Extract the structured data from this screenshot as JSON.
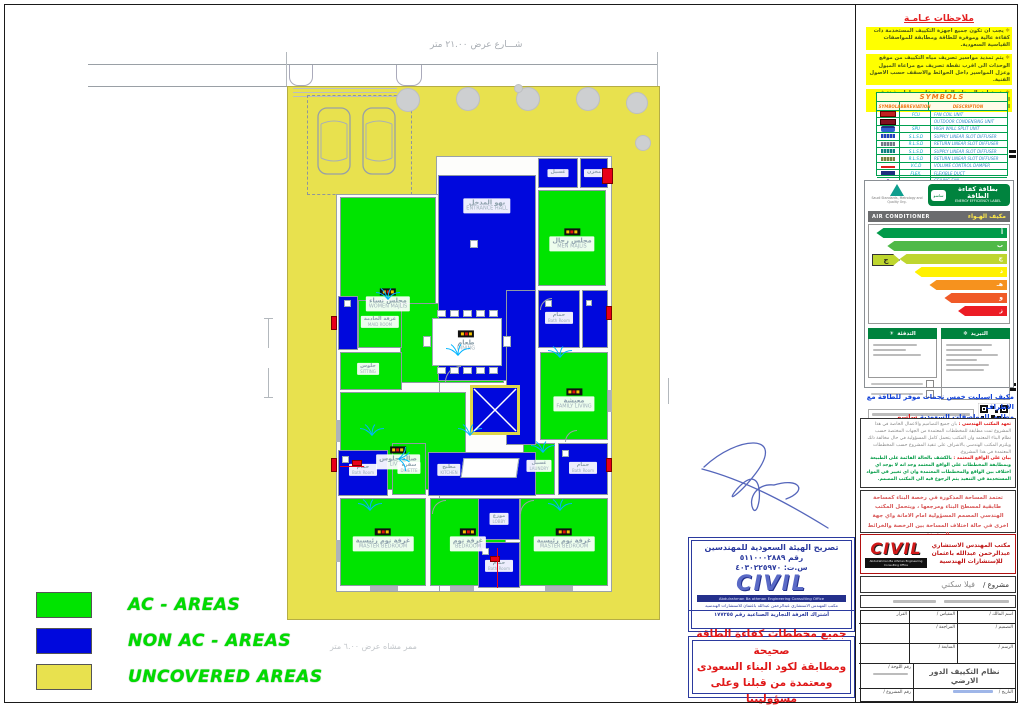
{
  "site": {
    "street_label": "شـــارع عرض ٢١.٠٠ متر",
    "walkway_label": "ممر مشاه عرض ٦.٠٠ متر"
  },
  "legend": {
    "items": [
      {
        "label": "AC - AREAS",
        "color": "#00e400"
      },
      {
        "label": "NON AC - AREAS",
        "color": "#0008dd"
      },
      {
        "label": "UNCOVERED AREAS",
        "color": "#e8e14e"
      }
    ]
  },
  "plan": {
    "rooms": {
      "women-majlis": {
        "ar": "مجلس نساء",
        "en": "WOMEN MAJLIS"
      },
      "men-majlis": {
        "ar": "مجلس رجال",
        "en": "MEN MAJLIS"
      },
      "dining": {
        "ar": "طعام",
        "en": "DINING"
      },
      "maid-room": {
        "ar": "غرفة الخادمة",
        "en": "MAID ROOM"
      },
      "sitting": {
        "ar": "جلوس",
        "en": "SITTING"
      },
      "living-hall": {
        "ar": "صالة جلوس",
        "en": "LIVING"
      },
      "family-living": {
        "ar": "معيشة",
        "en": "FAMILY LIVING"
      },
      "master-bedroom-left": {
        "ar": "غرفة نوم رئيسية",
        "en": "MASTER BEDROOM"
      },
      "bedroom-middle": {
        "ar": "غرفة نوم",
        "en": "BEDROOM"
      },
      "master-bedroom-right": {
        "ar": "غرفة نوم رئيسية",
        "en": "MASTER BEDROOM"
      },
      "laundry": {
        "ar": "غسيل",
        "en": "LAUNDRY"
      },
      "dinette": {
        "ar": "سفرة",
        "en": "DINETTE"
      },
      "entrance-hall": {
        "ar": "بهو المدخل",
        "en": "ENTRANCE HALL"
      },
      "store-a": {
        "ar": "غسيل",
        "en": ""
      },
      "store-b": {
        "ar": "مخزن",
        "en": ""
      },
      "bath-tr": {
        "ar": "حمام",
        "en": "Bath Room"
      },
      "bath-bl": {
        "ar": "حمام",
        "en": "Bath Room"
      },
      "kitchen": {
        "ar": "مطبخ",
        "en": "KITCHEN"
      },
      "lobby": {
        "ar": "موزع",
        "en": "LOBBY"
      },
      "bath-bm": {
        "ar": "حمام",
        "en": "Bath Room"
      },
      "bath-br": {
        "ar": "حمام",
        "en": "Bath Room"
      }
    }
  },
  "notes": {
    "title": "ملاحظات عـامـة",
    "items": [
      "يجب ان تكون جميع اجهزة التكييف المستخدمة ذات كفاءة عالية وموفرة للطاقة ومطابقة للمواصفات القياسية السعودية.",
      "يتم تمديد مواسير تصريف مياه التكييف من موقع الوحدات الى اقرب نقطة تصريف مع مراعاة الميول وعزل المواسير داخل الحوائط والاسقف حسب الاصول الفنية.",
      "يتم تعليق الوحدات الخارجية على حوامل مثبتة في الحوائط او على ارضية السطح مع مراعاة سهولة الصيانة والتهوية الجيدة."
    ]
  },
  "symbols": {
    "title": "SYMBOLS",
    "headers": [
      "SYMBOL",
      "ABBREVIATION",
      "DESCRIPTION"
    ],
    "rows": [
      {
        "abbr": "FCU",
        "desc": "FAN COIL UNIT"
      },
      {
        "abbr": "",
        "desc": "OUTDOOR CONDENSING UNIT"
      },
      {
        "abbr": "SPU",
        "desc": "HIGH WALL SPLIT UNIT"
      },
      {
        "abbr": "S.L.S.D",
        "desc": "SUPPLY LINEAR SLOT DIFFUSER"
      },
      {
        "abbr": "R.L.S.D",
        "desc": "RETURN LINEAR SLOT DIFFUSER"
      },
      {
        "abbr": "S.L.S.D",
        "desc": "SUPPLY LINEAR SLOT DIFFUSER"
      },
      {
        "abbr": "R.L.S.D",
        "desc": "RETURN LINEAR SLOT DIFFUSER"
      },
      {
        "abbr": "V.C.D",
        "desc": "VOLUME CONTROL DAMPER"
      },
      {
        "abbr": "FLEX.",
        "desc": "FLEXIBLE DUCT"
      },
      {
        "abbr": "",
        "desc": "CEILING FAN"
      }
    ]
  },
  "energy_label": {
    "title_ar": "بطاقة كفاءة الطاقة",
    "title_en": "ENERGY EFFICIENCY LABEL",
    "pill": "ساسو",
    "authority": "Saudi Standards, Metrology and Quality Org.",
    "product_en": "AIR CONDITIONER",
    "product_ar": "مكيف الهـواء",
    "grades": [
      "أ",
      "ب",
      "ج",
      "د",
      "هـ",
      "و",
      "ز"
    ],
    "bar_colors": [
      "#009a49",
      "#4fb948",
      "#bed62f",
      "#fff100",
      "#f6921e",
      "#f05a28",
      "#ec1c24"
    ],
    "pointer_index": 2,
    "pointer_grade": "ج",
    "cooling_title": "التبريد",
    "heating_title": "التدفئة",
    "cooling_icon": "❄",
    "heating_icon": "☀"
  },
  "statements": {
    "ac_line1": "مكيف اسبليت خمس نجمات موفر للطاقة مع الاطراف",
    "ac_line2": "مطابق للمواصفات السعودية",
    "ac_line2_red": "ساسو",
    "office_pledge_title": "تعهد المكتب الهندسي :",
    "office_pledge_text": "بان جميع التصاميم والاعمال الخاصة في هذا المشروع تمت مطابقة للمخططات المعتمدة من الجهات المختصة حسب نظام البناء المعتمد وان المكتب يتحمل كامل المسؤولية في حال مخالفة ذلك ويلتزم المكتب الهندسي بالاشراف على تنفيذ المشروع حسب المخططات المعتمدة في هذا المشروع.",
    "site_statement_title": "بيان على الواقع المعتمد :",
    "site_statement_text": "بالكشف بالحالة القائمة على الطبيعة وبمطابقة المخططات على الواقع المعتمد وجد انه لا يوجد اي اختلاف بين الواقع والمخططات المعتمدة وان اي تغيير في المواد المستخدمة في التنفيذ يتم الرجوع فيه الى المكتب المصمم.",
    "area_statement": "تعتمد المساحة المذكورة في رخصة البناء كمساحة طابقية لمسطح البناء ومرجعها ، ويتحمل المكتب الهندسي المصمم المسؤولية امام الامانة واي جهة اخرى في حالة اختلاف المساحة بين الرخصة والخرائط المعتمدة"
  },
  "stamp": {
    "line1": "تصريح الهيئة السعودية للمهندسين",
    "line2": "رقم ٥١١٠٠٠٢٨٨٩",
    "line3": "س.ت: ٤٠٣٠٢٢٥٩٧٠",
    "logo": "CIVIL",
    "office_en": "Abdulrahman Ba othman Engineering Consulting Office",
    "office_ar": "مكتب المهندس الاستشاري عبدالرحمن عبدالله باعثمان للاستشارات الهندسية",
    "cr_line": "أشتراك الغرفة التجارية الصناعية رقم ١٧٧٢٥٥"
  },
  "compliance": {
    "lines": [
      "جميع مخططات كفاءة الطاقة صحيحة",
      "ومطابقة لكود البناء السعودى",
      "ومعتمدة من قبلنا وعلى مسؤوليتنا"
    ]
  },
  "office_box": {
    "logo": "CIVIL",
    "en": "Abdulrahman Ba othman Engineering Consulting Office",
    "l1": "مكتب المهندس الاستشاري",
    "l2": "عبدالرحمن عبدالله باعثمان",
    "l3": "للإستشارات الهندسية"
  },
  "project_row": {
    "label": "مشروع /",
    "value": "فيلا سكني"
  },
  "title_table": {
    "owner": "اسم المالك /",
    "scale": "المقياس /",
    "decision": "القرار",
    "design": "التصميم /",
    "draw": "الرسم /",
    "review": "المراجعة /",
    "follow": "المتابعة /",
    "sheet_name_label": "اسم اللوحة /",
    "sheet_name": "نظام التكييف الدور الارضي",
    "sheet_no": "رقم اللوحة /",
    "date": "التاريخ /",
    "proj_no": "رقم المشروع /"
  }
}
